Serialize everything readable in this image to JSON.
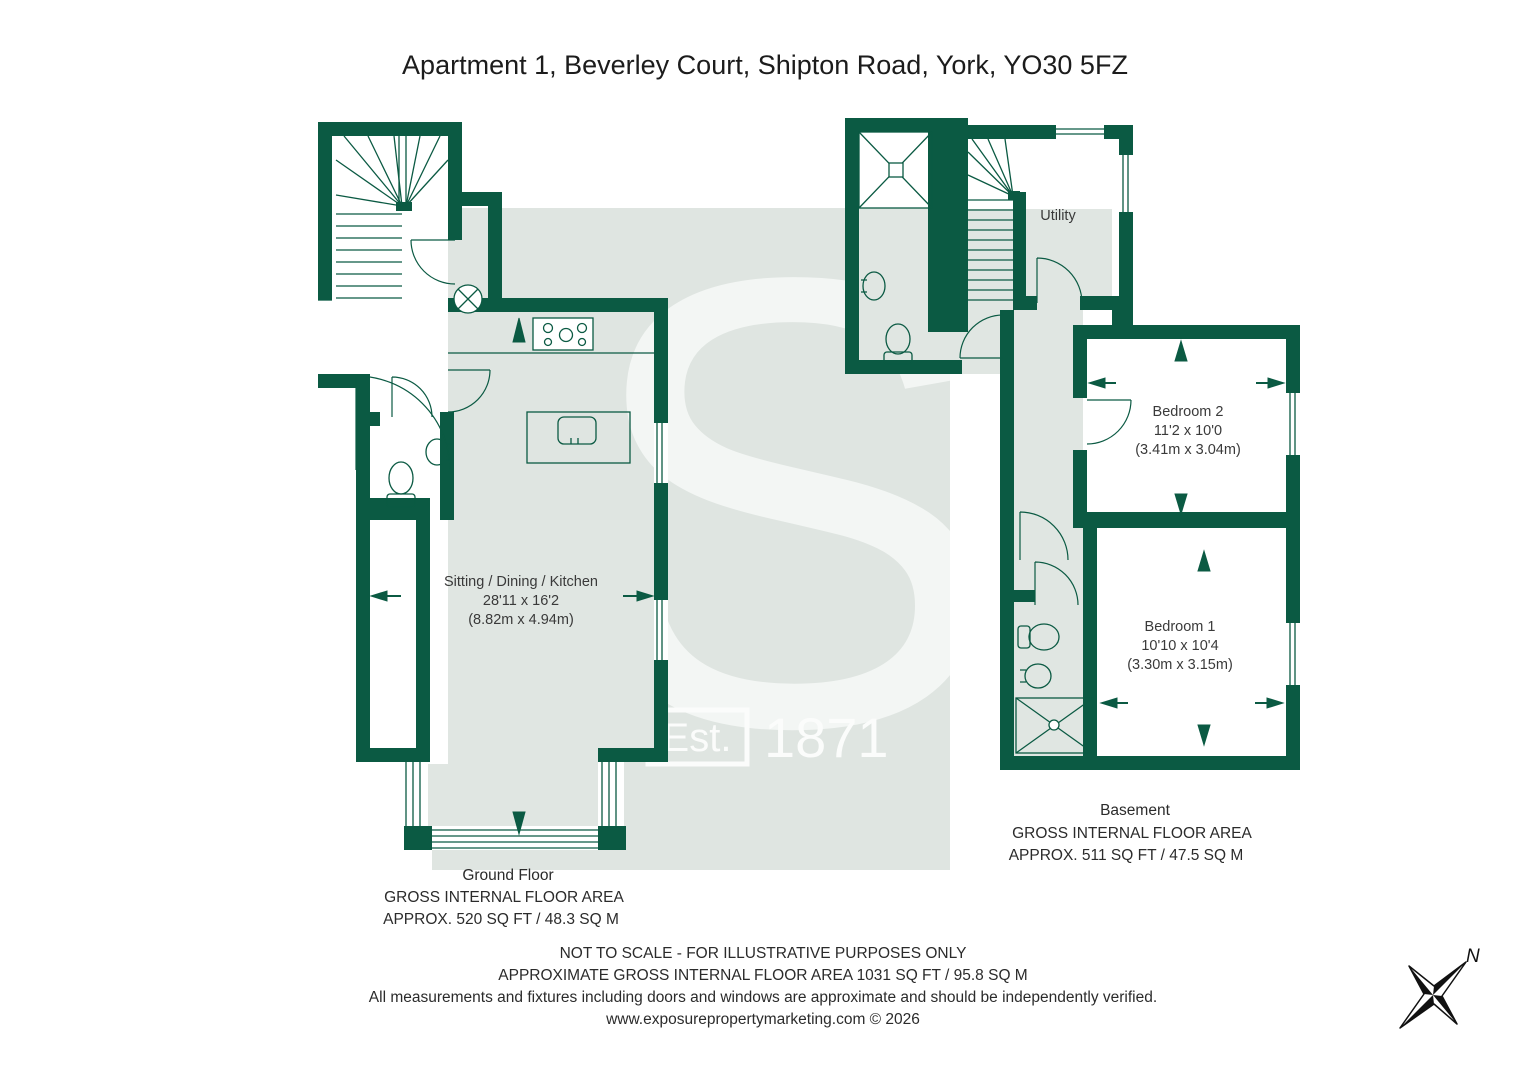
{
  "title": "Apartment 1, Beverley Court, Shipton Road, York, YO30 5FZ",
  "watermark": {
    "letter": "S",
    "est_label": "Est.",
    "year": "1871"
  },
  "ground_floor": {
    "room_label": "Sitting / Dining / Kitchen",
    "room_dims_imperial": "28'11 x 16'2",
    "room_dims_metric": "(8.82m x 4.94m)",
    "caption_title": "Ground Floor",
    "caption_line1": "GROSS INTERNAL FLOOR AREA",
    "caption_line2": "APPROX. 520 SQ FT / 48.3 SQ M"
  },
  "basement": {
    "utility_label": "Utility",
    "bedroom2_name": "Bedroom 2",
    "bedroom2_imperial": "11'2 x 10'0",
    "bedroom2_metric": "(3.41m x 3.04m)",
    "bedroom1_name": "Bedroom 1",
    "bedroom1_imperial": "10'10 x 10'4",
    "bedroom1_metric": "(3.30m x 3.15m)",
    "caption_title": "Basement",
    "caption_line1": "GROSS INTERNAL FLOOR AREA",
    "caption_line2": "APPROX. 511 SQ FT / 47.5 SQ M"
  },
  "footer": {
    "line1": "NOT TO SCALE - FOR ILLUSTRATIVE PURPOSES ONLY",
    "line2": "APPROXIMATE GROSS INTERNAL FLOOR AREA 1031 SQ FT / 95.8 SQ M",
    "line3": "All measurements and fixtures including doors and windows are approximate and should be independently verified.",
    "line4": "www.exposurepropertymarketing.com © 2026"
  },
  "compass": {
    "north_label": "N"
  },
  "colors": {
    "wall_green": "#0b5a43",
    "shade_grey": "#e0e6e2",
    "watermark_grey": "#dfe5e1"
  }
}
